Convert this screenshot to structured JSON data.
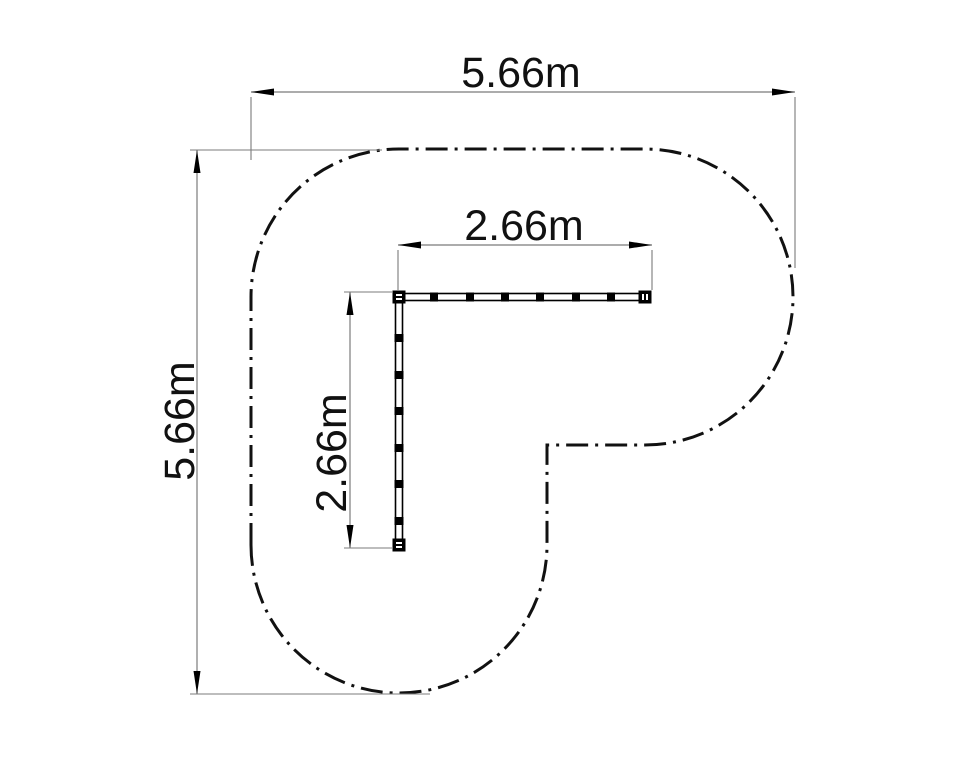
{
  "drawing": {
    "kind": "plan-view technical drawing with safety zone boundary",
    "dimensions": {
      "overall_width": "5.66m",
      "overall_height": "5.66m",
      "beam_horizontal": "2.66m",
      "beam_vertical": "2.66m"
    },
    "colors": {
      "outline": "#111111",
      "dimension_line": "#7b7b7b",
      "arrowhead": "#000000",
      "text": "#111111",
      "background": "#ffffff"
    }
  }
}
